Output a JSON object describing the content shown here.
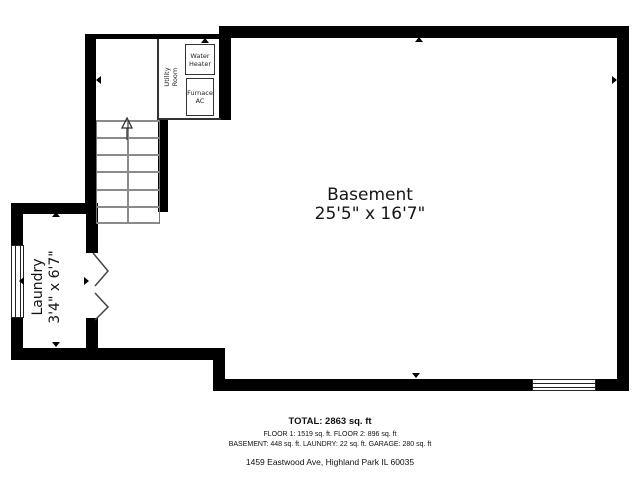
{
  "plan": {
    "basement": {
      "name": "Basement",
      "dims": "25'5\" x 16'7\""
    },
    "laundry": {
      "name": "Laundry",
      "dims": "3'4\" x 6'7\""
    },
    "utility_room": {
      "name": "Utility Room"
    },
    "water_heater": {
      "label": "Water Heater"
    },
    "furnace": {
      "label": "Furnace AC"
    }
  },
  "summary": {
    "total": "TOTAL: 2863 sq. ft",
    "floors": "FLOOR 1: 1519 sq. ft. FLOOR 2: 896 sq. ft",
    "areas": "BASEMENT: 448 sq. ft. LAUNDRY: 22 sq. ft. GARAGE: 280 sq. ft",
    "address": "1459 Eastwood Ave, Highland Park IL 60035"
  },
  "colors": {
    "wall": "#000000",
    "stair_line": "#8a8a8a",
    "text": "#111111",
    "background": "#ffffff"
  }
}
